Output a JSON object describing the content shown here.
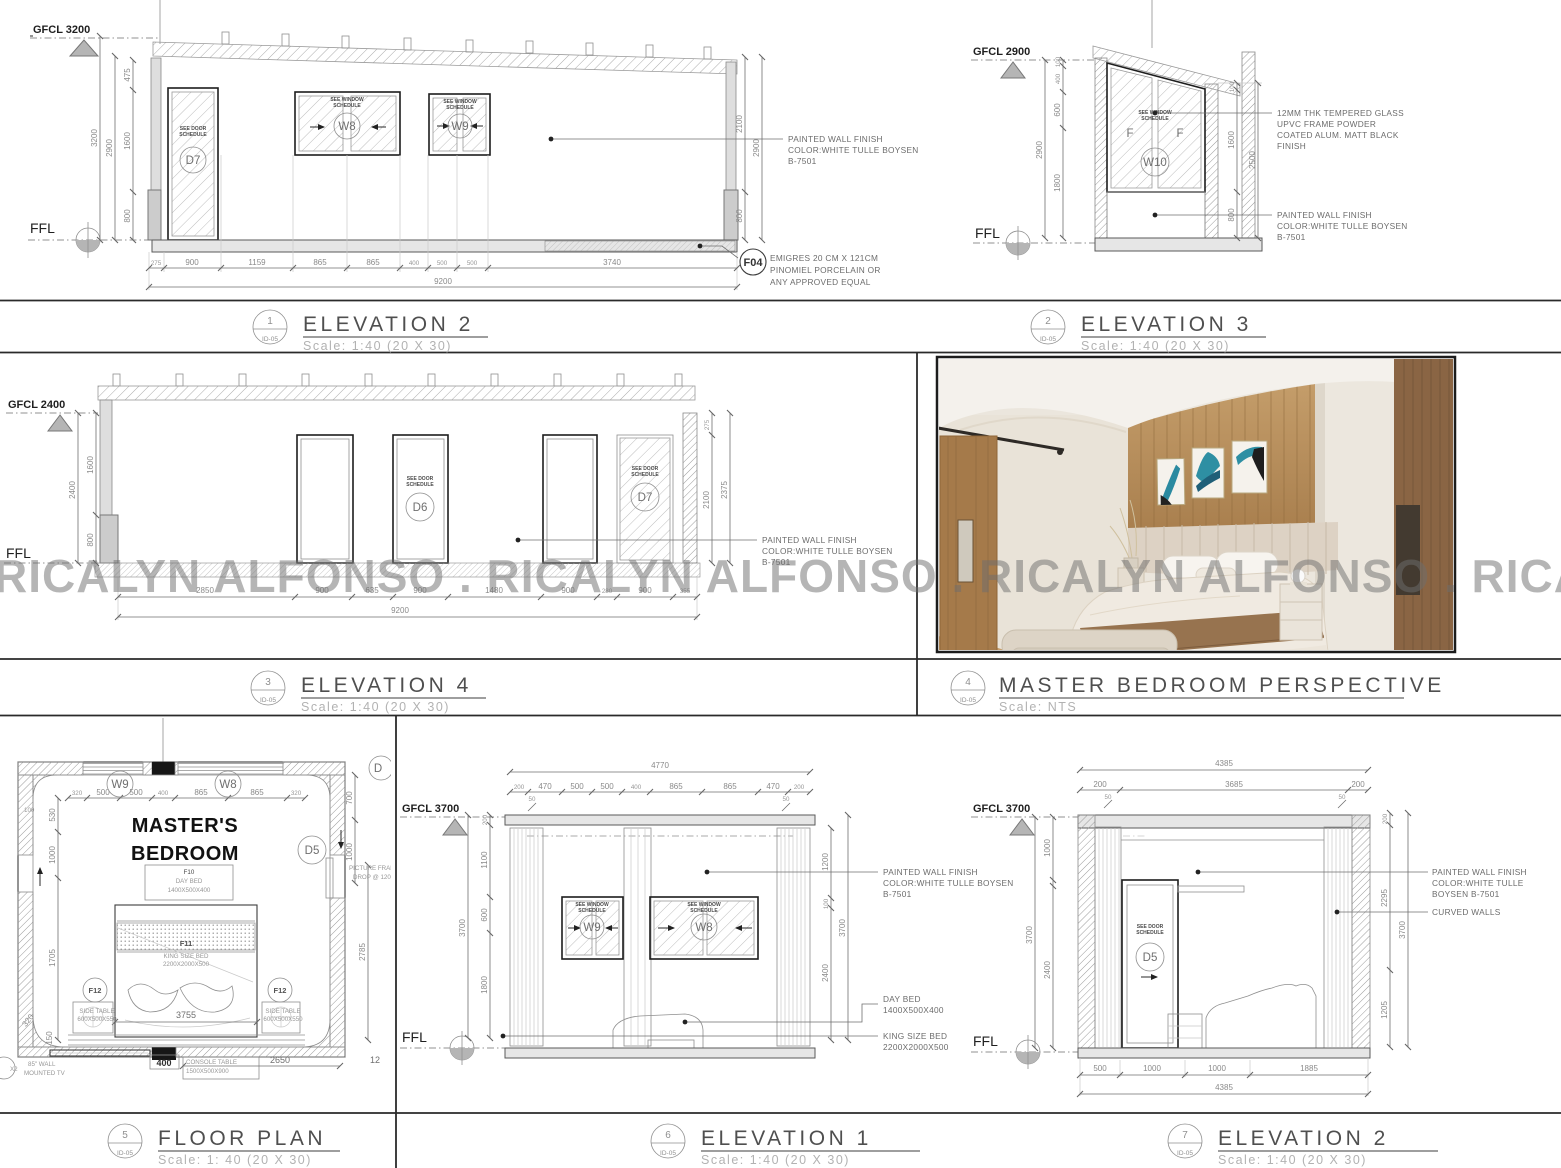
{
  "watermark": "RICALYN ALFONSO . RICALYN ALFONSO . RICALYN ALFONSO . RICALYN ALFONSO",
  "palette": {
    "line_dark": "#3c3c3c",
    "line_gray": "#8f8f8f",
    "wood": "#a77d4c",
    "art_teal": "#2e8fa3",
    "floor_wood": "#c79e6c"
  },
  "levels": {
    "gfcl3200": "GFCL 3200",
    "gfcl2900": "GFCL 2900",
    "gfcl2400": "GFCL 2400",
    "gfcl3700": "GFCL 3700",
    "ffl": "FFL"
  },
  "tags": {
    "d5": "D5",
    "d6": "D6",
    "d7": "D7",
    "w8": "W8",
    "w9": "W9",
    "w10": "W10",
    "f": "F",
    "f04": "F04",
    "f12": "F12"
  },
  "notes": {
    "wall": [
      "PAINTED WALL FINISH",
      "COLOR:WHITE TULLE BOYSEN",
      "B-7501"
    ],
    "wall3": [
      "PAINTED WALL FINISH",
      "COLOR:WHITE TULLE",
      "BOYSEN B-7501"
    ],
    "glass": [
      "12MM THK TEMPERED GLASS",
      "UPVC FRAME POWDER",
      "COATED ALUM. MATT BLACK",
      "FINISH"
    ],
    "tile": [
      "EMIGRES 20 CM X 121CM",
      "PINOMIEL PORCELAIN OR",
      "ANY APPROVED EQUAL"
    ],
    "curved": "CURVED WALLS",
    "daybed": [
      "DAY BED",
      "1400X500X400"
    ],
    "kingbed": [
      "KING SIZE BED",
      "2200X2000X500"
    ],
    "seedoor": [
      "SEE DOOR",
      "SCHEDULE"
    ],
    "seewin": [
      "SEE WINDOW",
      "SCHEDULE"
    ]
  },
  "elev2tl": {
    "lo": [
      "3200",
      "2900"
    ],
    "li": [
      "475",
      "1600",
      "800"
    ],
    "r": [
      "2100",
      "800",
      "2900"
    ],
    "b": [
      "275",
      "900",
      "1159",
      "865",
      "865",
      "400",
      "500",
      "500",
      "3740"
    ],
    "total": "9200"
  },
  "elev3": {
    "lo": "2900",
    "li": [
      "100",
      "400",
      "600",
      "1800"
    ],
    "ri": [
      "100",
      "1600",
      "800"
    ],
    "ro": "2500"
  },
  "elev4": {
    "lo": "2400",
    "li": [
      "1600",
      "800"
    ],
    "r": [
      "275",
      "2100",
      "2375"
    ],
    "b": [
      "2850",
      "900",
      "635",
      "900",
      "1480",
      "900",
      "280",
      "900",
      "355"
    ],
    "total": "9200"
  },
  "plan": {
    "room": [
      "MASTER'S",
      "BEDROOM"
    ],
    "top": [
      "320",
      "500",
      "500",
      "400",
      "865",
      "865",
      "320"
    ],
    "left100": "100",
    "left": [
      "530",
      "1000",
      "1705"
    ],
    "ang320": "320",
    "ang150": "150",
    "right": [
      "700",
      "1000"
    ],
    "right_total": "2785",
    "d3755": "3755",
    "d400": "400",
    "d2650": "2650",
    "d12": "12",
    "d_partial": "D",
    "x2": "X2",
    "f10": [
      "F10",
      "DAY BED",
      "1400X500X400"
    ],
    "f11": [
      "F11",
      "KING SIZE BED",
      "2200X2000X500"
    ],
    "sidetable": [
      "SIDE TABLE",
      "600X500X550"
    ],
    "tv": [
      "85\" WALL",
      "MOUNTED TV"
    ],
    "console": [
      "CONSOLE TABLE",
      "1500X500X900"
    ],
    "picture": [
      "PICTURE FRAME",
      "DROP @ 120"
    ]
  },
  "elev1": {
    "t": "4770",
    "trow": [
      "200",
      "470",
      "500",
      "500",
      "400",
      "865",
      "865",
      "470",
      "200"
    ],
    "fifty": [
      "50",
      "50"
    ],
    "li": [
      "200",
      "1100",
      "600",
      "1800"
    ],
    "lo": "3700",
    "ri": [
      "1200",
      "100",
      "2400"
    ],
    "ro": "3700"
  },
  "elev2br": {
    "t": "4385",
    "trow": [
      "200",
      "3685",
      "200"
    ],
    "fifty": [
      "50",
      "50"
    ],
    "li": [
      "1000",
      "2400"
    ],
    "lo": "3700",
    "ri": [
      "200",
      "2295",
      "1205"
    ],
    "ro": "3700",
    "b": [
      "500",
      "1000",
      "1000",
      "1885"
    ],
    "bt": "4385"
  },
  "titles": [
    {
      "num": "1",
      "ref": "ID-05",
      "name": "ELEVATION 2",
      "scale": "Scale: 1:40 (20 X 30)"
    },
    {
      "num": "2",
      "ref": "ID-05",
      "name": "ELEVATION 3",
      "scale": "Scale: 1:40 (20 X 30)"
    },
    {
      "num": "3",
      "ref": "ID-05",
      "name": "ELEVATION 4",
      "scale": "Scale: 1:40 (20 X 30)"
    },
    {
      "num": "4",
      "ref": "ID-05",
      "name": "MASTER BEDROOM PERSPECTIVE",
      "scale": "Scale: NTS"
    },
    {
      "num": "5",
      "ref": "ID-05",
      "name": "FLOOR PLAN",
      "scale": "Scale: 1: 40 (20 X 30)"
    },
    {
      "num": "6",
      "ref": "ID-05",
      "name": "ELEVATION 1",
      "scale": "Scale: 1:40 (20 X 30)"
    },
    {
      "num": "7",
      "ref": "ID-05",
      "name": "ELEVATION 2",
      "scale": "Scale: 1:40 (20 X 30)"
    }
  ]
}
